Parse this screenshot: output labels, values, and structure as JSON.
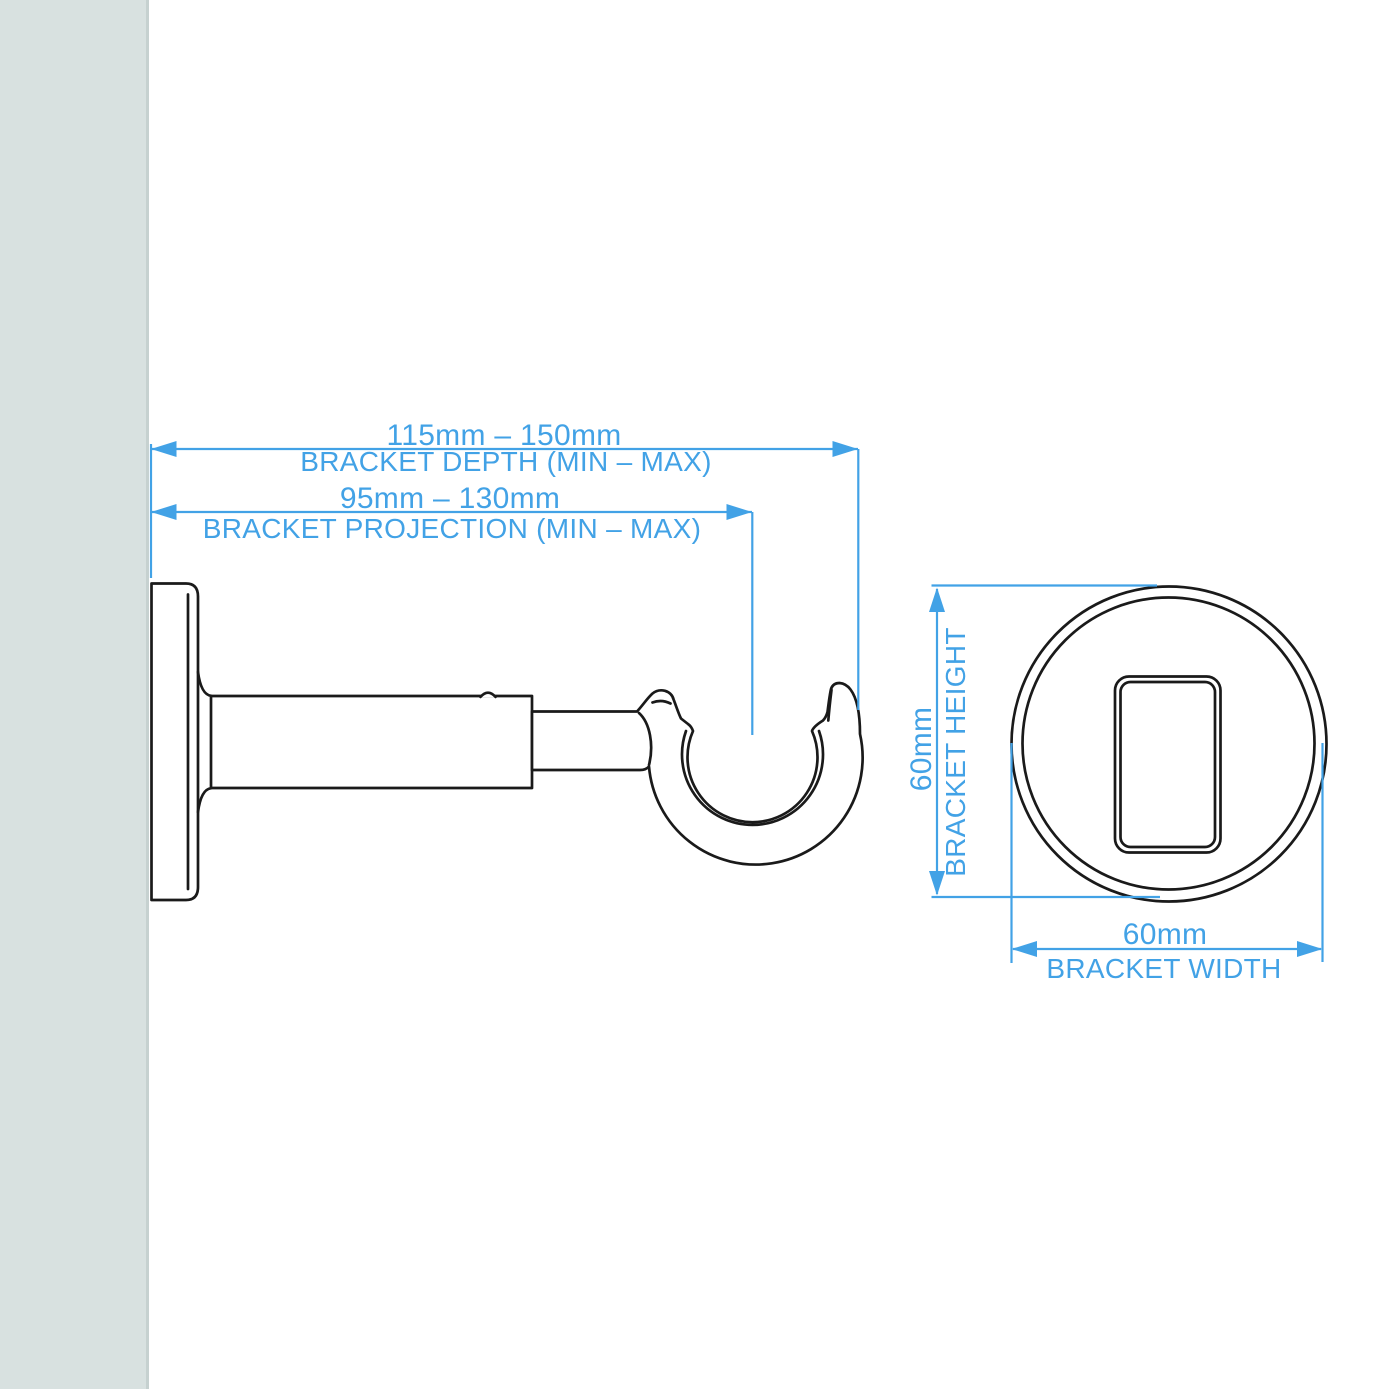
{
  "colors": {
    "accent": "#42a2e6",
    "ink": "#1a1a1a",
    "wall": "#d8e1e0",
    "wall_edge": "#c6d1d0",
    "background": "#ffffff"
  },
  "annotations": {
    "depth": {
      "value": "115mm – 150mm",
      "label": "BRACKET DEPTH (MIN – MAX)"
    },
    "projection": {
      "value": "95mm – 130mm",
      "label": "BRACKET PROJECTION (MIN – MAX)"
    },
    "height": {
      "value": "60mm",
      "label": "BRACKET HEIGHT"
    },
    "width": {
      "value": "60mm",
      "label": "BRACKET WIDTH"
    }
  }
}
